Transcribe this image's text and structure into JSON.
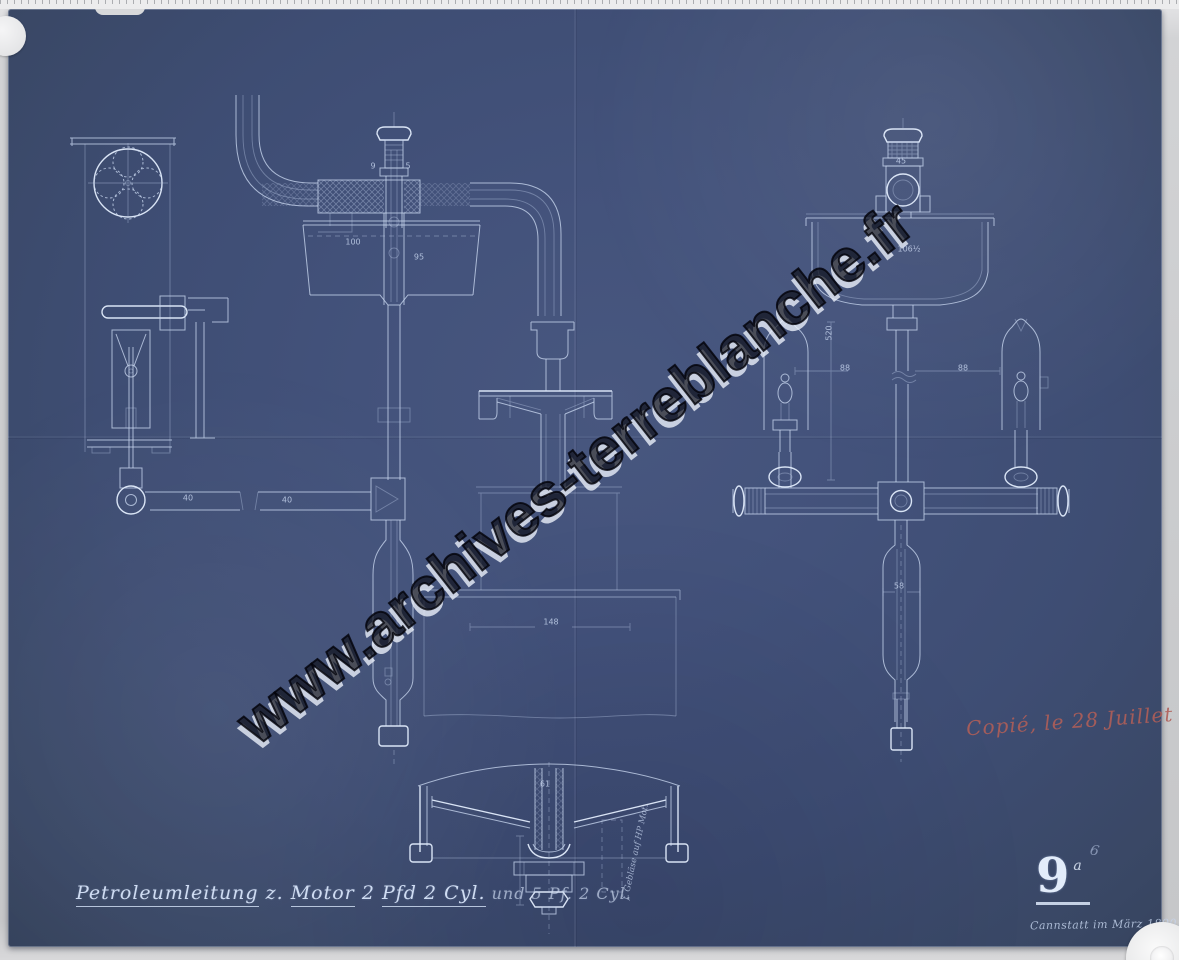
{
  "sheet": {
    "title": {
      "parts": [
        {
          "text": "Petroleumleitung",
          "underline": true
        },
        {
          "text": " z. ",
          "underline": false
        },
        {
          "text": "Motor",
          "underline": true
        },
        {
          "text": " 2 ",
          "underline": false
        },
        {
          "text": "Pfd 2 Cyl.",
          "underline": true
        },
        {
          "text": "  und 5 Pf. 2 Cyl.",
          "underline": false,
          "faint": true
        }
      ]
    },
    "drawing_number": "9",
    "drawing_number_suffix": "a",
    "pencil_mark": "6",
    "place_date_note": "Cannstatt im März 1890.",
    "copy_note": "Copié, le 28 Juillet 90",
    "detail_note": "f. Gebläse auf HP Mot.",
    "dimension_labels": [
      {
        "text": "9",
        "x": 373,
        "y": 166
      },
      {
        "text": "5",
        "x": 408,
        "y": 166
      },
      {
        "text": "100",
        "x": 353,
        "y": 242
      },
      {
        "text": "95",
        "x": 419,
        "y": 257
      },
      {
        "text": "148",
        "x": 551,
        "y": 622
      },
      {
        "text": "61",
        "x": 545,
        "y": 784
      },
      {
        "text": "40",
        "x": 188,
        "y": 498
      },
      {
        "text": "40",
        "x": 287,
        "y": 500
      },
      {
        "text": "45",
        "x": 901,
        "y": 161
      },
      {
        "text": "106½",
        "x": 909,
        "y": 249
      },
      {
        "text": "520",
        "x": 829,
        "y": 333,
        "rot": -90
      },
      {
        "text": "88",
        "x": 845,
        "y": 368
      },
      {
        "text": "88",
        "x": 963,
        "y": 368
      },
      {
        "text": "58",
        "x": 899,
        "y": 586
      }
    ]
  },
  "watermark": {
    "text": "www.archives-terreblanche.fr",
    "angle_deg": -38
  },
  "palette": {
    "blueprint_blue": "#3f4e74",
    "line_white": "#c9d7f0",
    "mat_gray": "#cbccce",
    "stamp_red": "#b05e58",
    "watermark_dark": "#0d0f18",
    "watermark_light": "#edf1f9"
  }
}
